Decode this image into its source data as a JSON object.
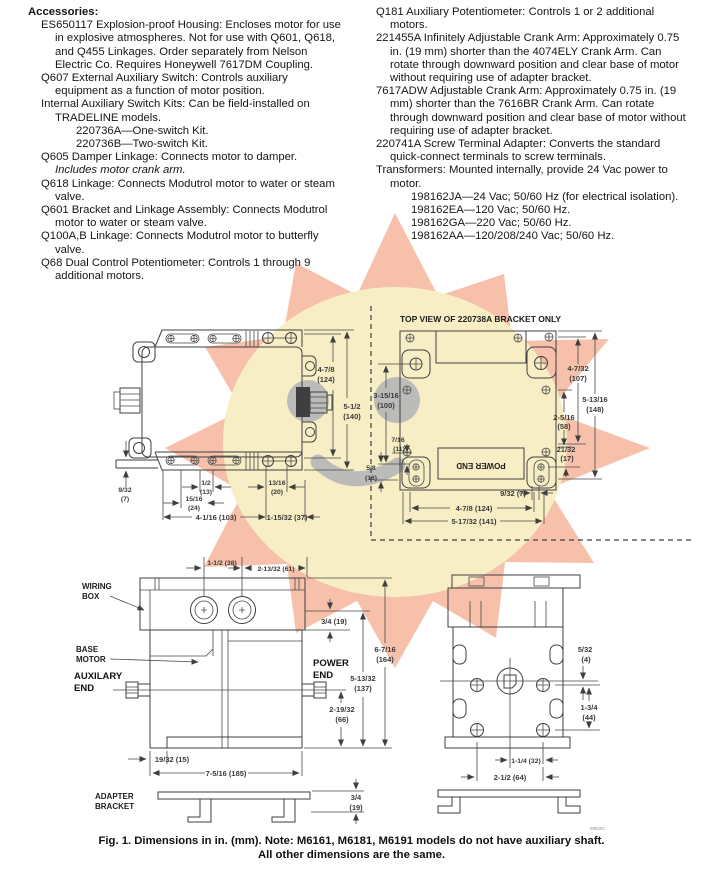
{
  "watermark": {
    "star_color": "#f6c0aa",
    "center_color": "#f8eec5",
    "accent_gray": "#a9aeb6"
  },
  "accessories": {
    "heading": "Accessories:",
    "items": [
      {
        "text": "ES650117 Explosion-proof Housing: Encloses motor for use in explosive atmospheres. Not for use with Q601, Q618, and Q455 Linkages. Order separately from Nelson Electric Co. Requires Honeywell 7617DM Coupling."
      },
      {
        "text": "Q607 External Auxiliary Switch: Controls auxiliary equipment as a function of motor position."
      },
      {
        "text": "Internal Auxiliary Switch Kits: Can be field-installed on TRADELINE models."
      },
      {
        "text": "220736A—One-switch Kit."
      },
      {
        "text": "220736B—Two-switch Kit."
      },
      {
        "text": "Q605 Damper Linkage: Connects motor to damper."
      },
      {
        "text": "Includes motor crank arm."
      },
      {
        "text": "Q618 Linkage: Connects Modutrol motor to water or steam valve."
      },
      {
        "text": "Q601 Bracket and Linkage Assembly: Connects Modutrol motor to water or steam valve."
      },
      {
        "text": "Q100A,B Linkage: Connects Modutrol motor to butterfly valve."
      },
      {
        "text": "Q68 Dual Control Potentiometer: Controls 1 through 9 additional motors."
      }
    ]
  },
  "accessories_right": {
    "items": [
      {
        "text": "Q181 Auxiliary Potentiometer: Controls 1 or 2 additional motors."
      },
      {
        "text": "221455A Infinitely Adjustable Crank Arm: Approximately 0.75 in. (19 mm) shorter than the 4074ELY Crank Arm. Can rotate through downward position and clear base of motor without requiring use of adapter bracket."
      },
      {
        "text": "7617ADW Adjustable Crank Arm: Approximately 0.75 in. (19 mm) shorter than the 7616BR Crank Arm. Can rotate through downward position and clear base of motor without requiring use of adapter bracket."
      },
      {
        "text": "220741A Screw Terminal Adapter: Converts the standard quick-connect terminals to screw terminals."
      },
      {
        "text": "Transformers: Mounted internally, provide 24 Vac power to motor."
      },
      {
        "text": "198162JA—24 Vac; 50/60 Hz (for electrical isolation)."
      },
      {
        "text": "198162EA—120 Vac; 50/60 Hz."
      },
      {
        "text": "198162GA—220 Vac; 50/60 Hz."
      },
      {
        "text": "198162AA—120/208/240 Vac; 50/60 Hz."
      }
    ]
  },
  "figure": {
    "bracket_title": "TOP VIEW OF 220738A BRACKET ONLY",
    "caption_line1": "Fig. 1. Dimensions in in. (mm). Note: M6161, M6181, M6191 models do not have auxiliary shaft.",
    "caption_line2": "All other dimensions are the same.",
    "motor_top": {
      "d1a": "4-7/8",
      "d1b": "(124)",
      "d2a": "5-1/2",
      "d2b": "(140)",
      "d3a": "9/32",
      "d3b": "(7)",
      "d4a": "1/2",
      "d4b": "(13)",
      "d5a": "13/16",
      "d5b": "(20)",
      "d6a": "15/16",
      "d6b": "(24)",
      "d7": "4-1/16 (103)",
      "d8": "1-15/32 (37)"
    },
    "bracket_top": {
      "power_end": "POWER END",
      "d1a": "3-15/16",
      "d1b": "(100)",
      "d2a": "7/16",
      "d2b": "(11)",
      "d3a": "5/8",
      "d3b": "(16)",
      "d4a": "4-7/32",
      "d4b": "(107)",
      "d5a": "5-13/16",
      "d5b": "(148)",
      "d6a": "2-5/16",
      "d6b": "(58)",
      "d7a": "21/32",
      "d7b": "(17)",
      "d8": "9/32 (7)",
      "d9": "4-7/8 (124)",
      "d10": "5-17/32 (141)"
    },
    "motor_side": {
      "wiring_1": "WIRING",
      "wiring_2": "BOX",
      "base_1": "BASE",
      "base_2": "MOTOR",
      "aux_1": "AUXILARY",
      "aux_2": "END",
      "power_1": "POWER",
      "power_2": "END",
      "adapter_1": "ADAPTER",
      "adapter_2": "BRACKET",
      "d1": "1-1/2 (38)",
      "d2": "2-13/32 (61)",
      "d3": "3/4 (19)",
      "d4a": "6-7/16",
      "d4b": "(164)",
      "d5a": "5-13/32",
      "d5b": "(137)",
      "d6a": "2-19/32",
      "d6b": "(66)",
      "d7": "19/32 (15)",
      "d8": "7-5/16 (185)",
      "d9a": "3/4",
      "d9b": "(19)"
    },
    "motor_end": {
      "d1a": "5/32",
      "d1b": "(4)",
      "d2a": "1-3/4",
      "d2b": "(44)",
      "d3": "1-1/4 (32)",
      "d4": "2-1/2 (64)",
      "code": "M302G"
    }
  }
}
